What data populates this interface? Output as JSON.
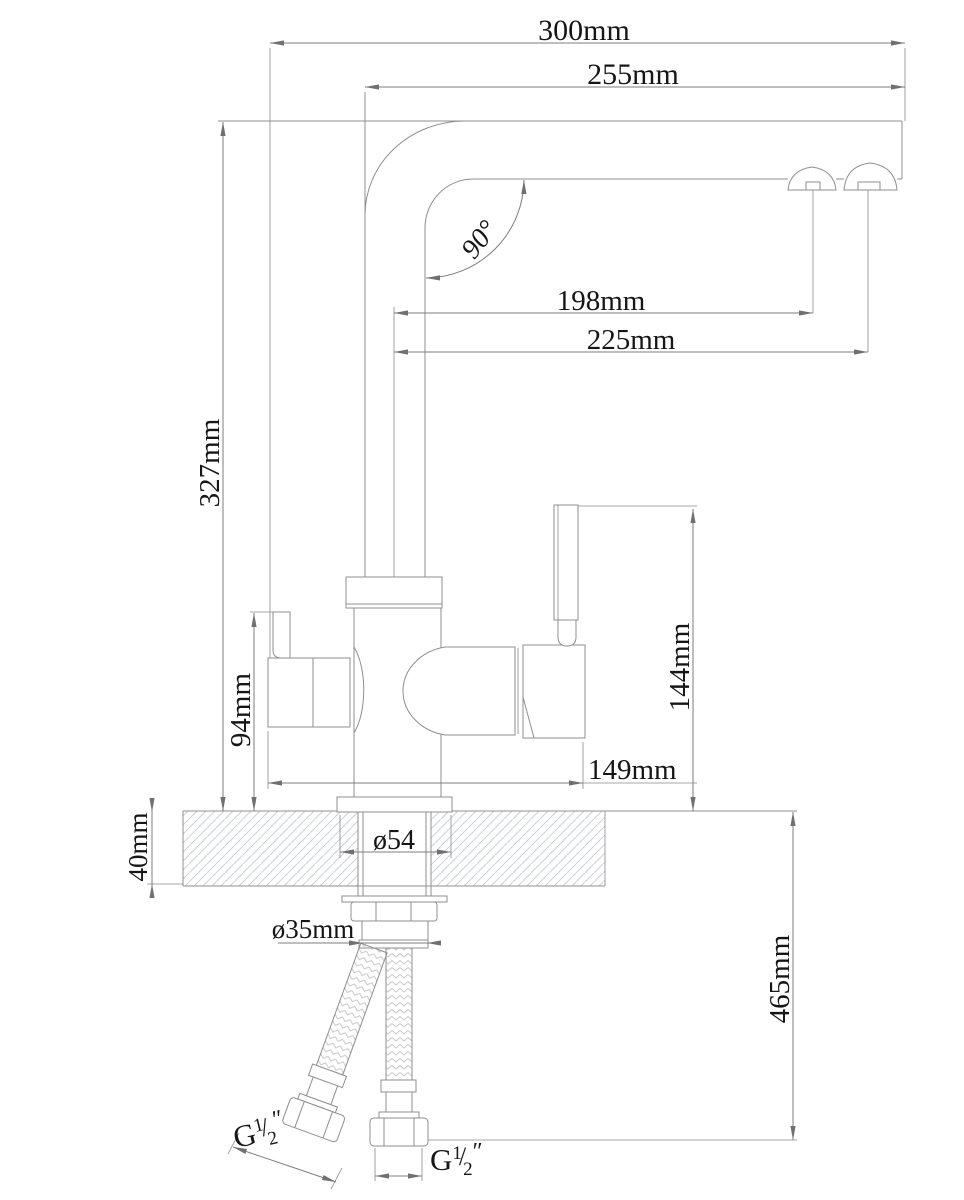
{
  "document": {
    "kind": "technical drawing",
    "subject": "kitchen mixer faucet with filter channel — dimensioned side elevation with countertop section and supply hoses",
    "units": "mm"
  },
  "labels": {
    "reach_total": "300mm",
    "reach_spout": "255mm",
    "aerator_near": "198mm",
    "aerator_far": "225mm",
    "spout_angle": "90°",
    "height_to_spout": "327mm",
    "left_handle_height": "94mm",
    "right_handle_height": "144mm",
    "body_span": "149mm",
    "counter_thickness": "40mm",
    "hose_drop": "465mm",
    "base_diameter": "ø54",
    "hole_diameter": "ø35mm",
    "thread": {
      "G": "G",
      "sup": "1",
      "slash": "/",
      "sub": "2",
      "inch": "″"
    }
  },
  "colors": {
    "background": "#ffffff",
    "part_line": "#8f8f8f",
    "dimension_line": "#7c7c7c",
    "text": "#161616",
    "hatch": "#ccd1d5",
    "braid": "#c6c6c6"
  }
}
